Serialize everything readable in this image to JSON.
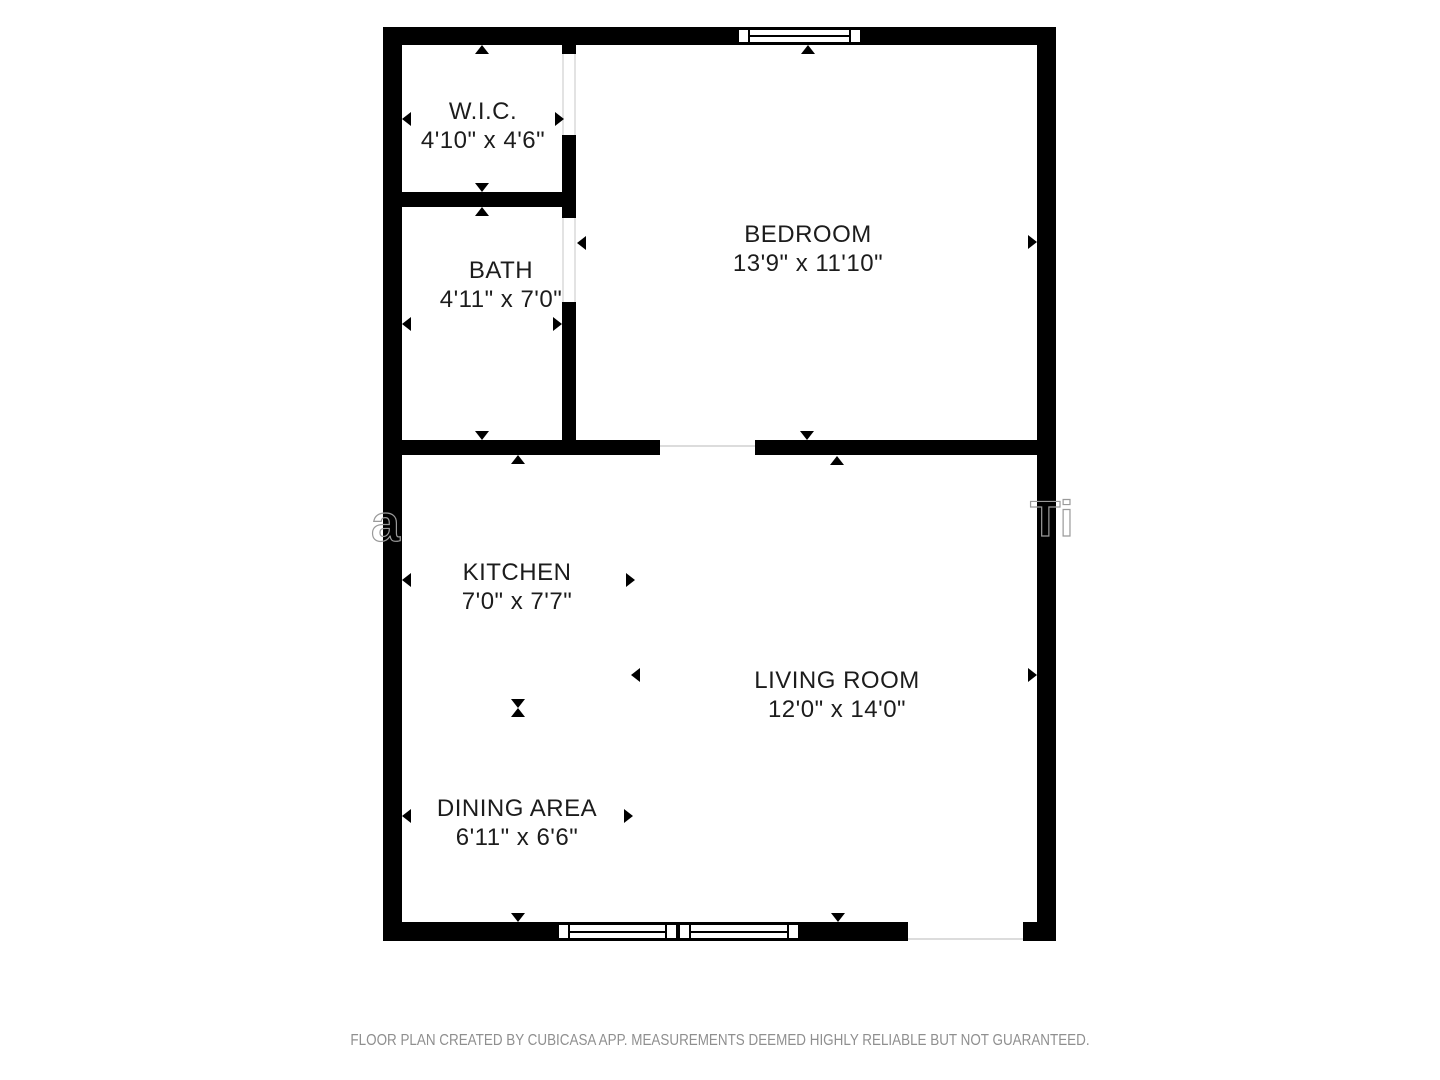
{
  "floorplan": {
    "rooms": [
      {
        "id": "wic",
        "label": "W.I.C.",
        "dims": "4'10\" x 4'6\""
      },
      {
        "id": "bath",
        "label": "BATH",
        "dims": "4'11\" x 7'0\""
      },
      {
        "id": "bedroom",
        "label": "BEDROOM",
        "dims": "13'9\" x 11'10\""
      },
      {
        "id": "kitchen",
        "label": "KITCHEN",
        "dims": "7'0\" x 7'7\""
      },
      {
        "id": "living",
        "label": "LIVING ROOM",
        "dims": "12'0\" x 14'0\""
      },
      {
        "id": "dining",
        "label": "DINING AREA",
        "dims": "6'11\" x 6'6\""
      }
    ],
    "watermark": {
      "left_fragment": "a",
      "right_fragment": "Ti"
    },
    "colors": {
      "wall": "#000000",
      "label": "#1c1c1c",
      "opening_line": "#e0e0e0",
      "watermark": "#9a9a9a",
      "footer_text": "#8f8f8f"
    }
  },
  "footer": {
    "text": "FLOOR PLAN CREATED BY CUBICASA APP. MEASUREMENTS DEEMED HIGHLY RELIABLE BUT NOT GUARANTEED."
  }
}
